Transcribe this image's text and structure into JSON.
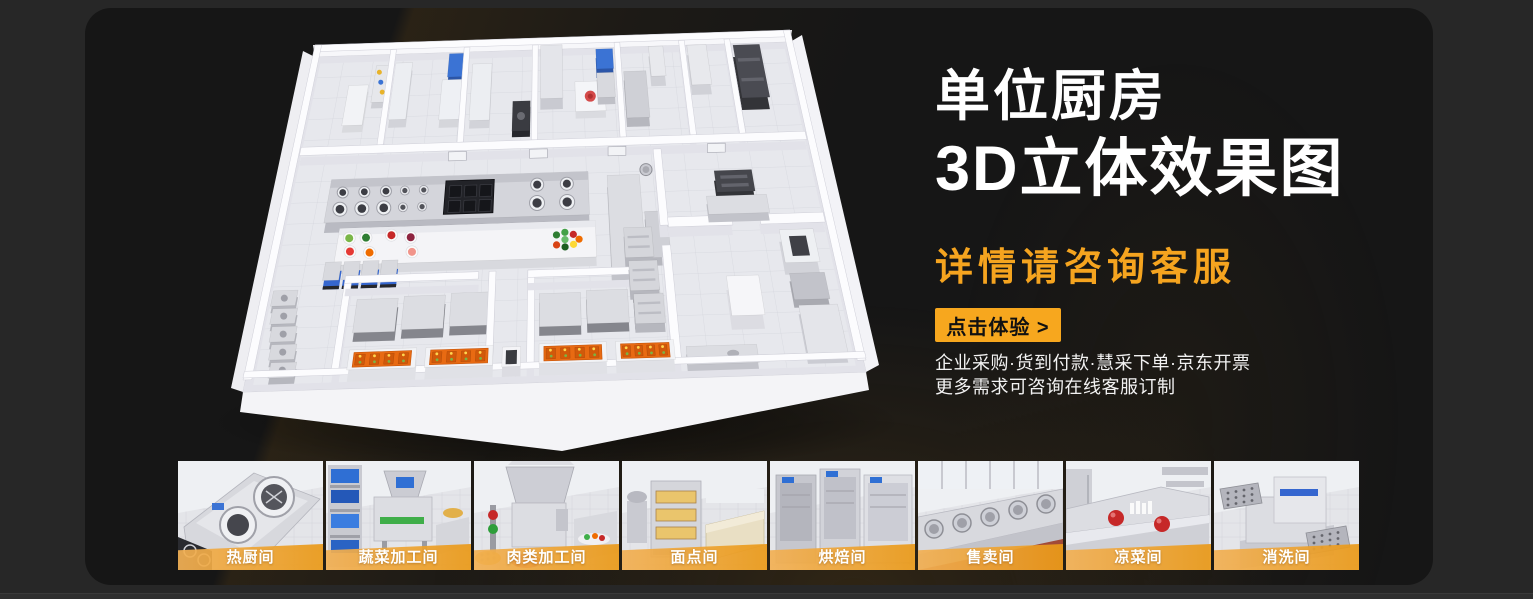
{
  "panel": {
    "headline_line1": "单位厨房",
    "headline_line2": "3D立体效果图",
    "subheadline": "详情请咨询客服",
    "cta_label": "点击体验 >",
    "notes_line1": "企业采购·货到付款·慧采下单·京东开票",
    "notes_line2": "更多需求可咨询在线客服订制",
    "colors": {
      "accent_orange": "#F7A71E",
      "subheadline_orange": "#F5A41F",
      "label_bar_start": "#F2B054",
      "label_bar_end": "#EA9917"
    }
  },
  "thumbnails": [
    {
      "label": "热厨间",
      "scene": "hot-kitchen"
    },
    {
      "label": "蔬菜加工间",
      "scene": "vegetable-processing"
    },
    {
      "label": "肉类加工间",
      "scene": "meat-processing"
    },
    {
      "label": "面点间",
      "scene": "pastry"
    },
    {
      "label": "烘焙间",
      "scene": "baking"
    },
    {
      "label": "售卖间",
      "scene": "selling"
    },
    {
      "label": "凉菜间",
      "scene": "cold-dish"
    },
    {
      "label": "消洗间",
      "scene": "washing"
    }
  ]
}
